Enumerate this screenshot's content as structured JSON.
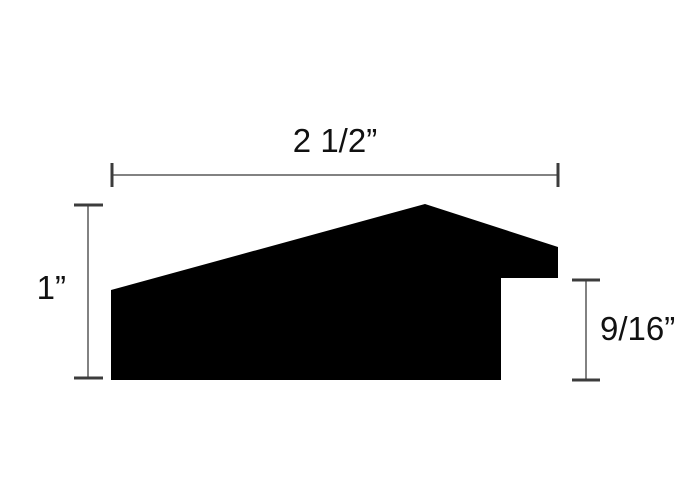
{
  "diagram": {
    "labels": {
      "width": "2 1/2”",
      "height": "1”",
      "rabbet_depth": "9/16”"
    },
    "colors": {
      "background": "#ffffff",
      "profile": "#000000",
      "dimension_line": "#828282",
      "dimension_cap": "#3c3c3c",
      "label_text": "#111111"
    }
  }
}
